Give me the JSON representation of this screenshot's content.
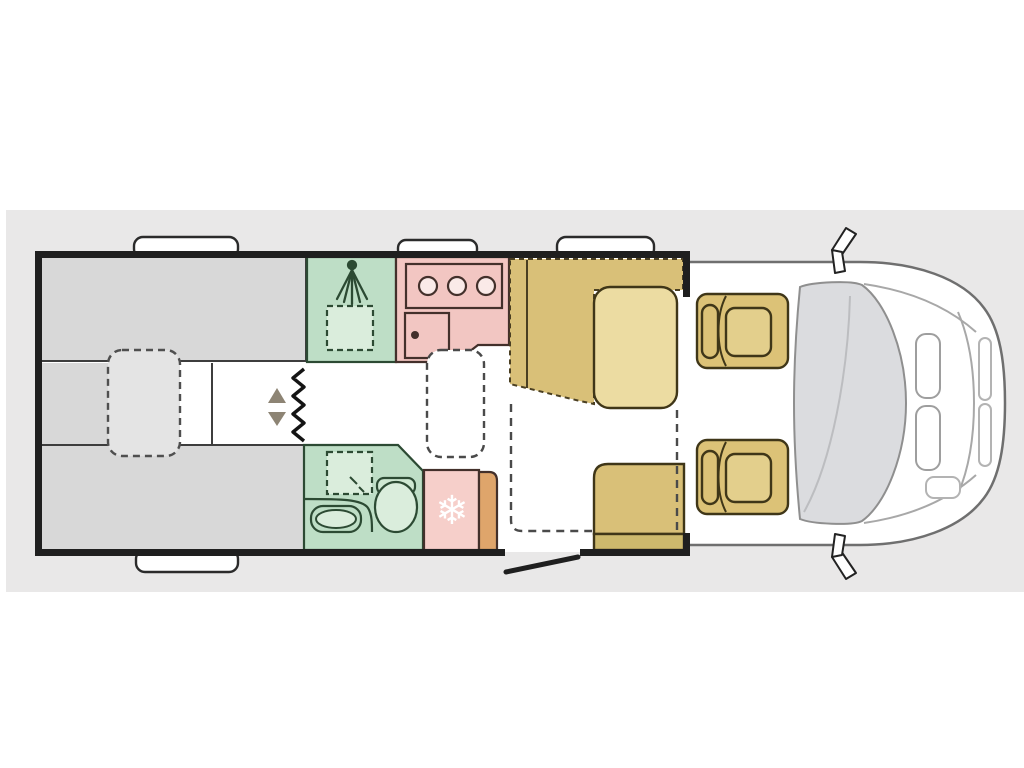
{
  "palette": {
    "page_bg": "#ffffff",
    "band_bg": "#e9e8e8",
    "interior_bg": "#ffffff",
    "wall": "#1f1f1f",
    "bed_gray": "#d8d8d8",
    "bed_infill": "#e4e4e4",
    "step_arrow": "#8d8474",
    "ladder": "#141414",
    "green": "#bedec6",
    "green_light": "#daeddc",
    "pink": "#f2c6c2",
    "pink_light": "#f6cfca",
    "pink_pale": "#faeae8",
    "orange": "#dfa56b",
    "tan": "#d9c078",
    "tan_dark": "#cdb96d",
    "tan_light": "#ecdca2",
    "seat_tan": "#dcc277",
    "seat_cushion": "#e3cf8c",
    "windshield": "#dbdcdf",
    "window_tab": "#ffffff",
    "snowflake": "#ffffff"
  },
  "icons": {
    "snowflake": "❄"
  }
}
